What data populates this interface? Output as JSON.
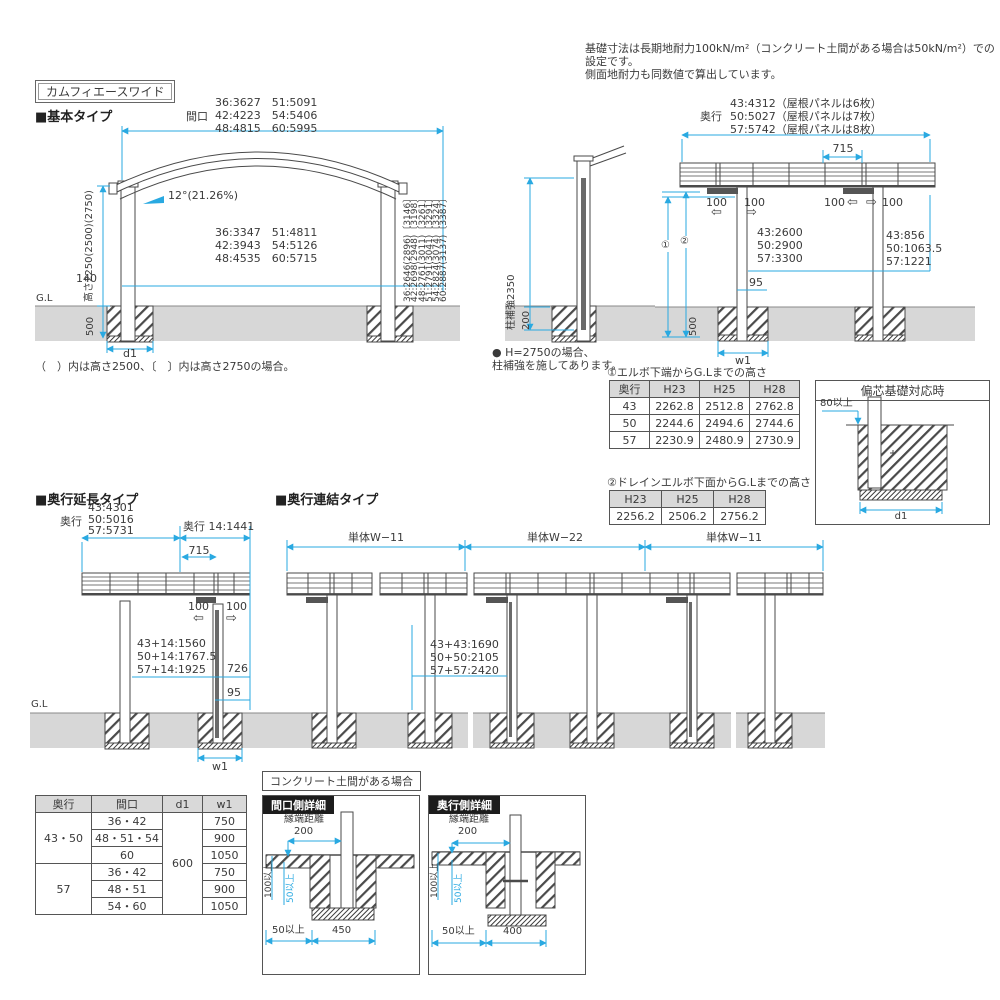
{
  "colors": {
    "dimension": "#29a9e1",
    "ground": "#d7d7d7",
    "table_header": "#d9d9d9",
    "ink": "#3a3a3a"
  },
  "note": {
    "line1": "基礎寸法は長期地耐力100kN/m²（コンクリート土間がある場合は50kN/m²）での設定です。",
    "line2": "側面地耐力も同数値で算出しています。"
  },
  "title": "カムフィエースワイド",
  "basic": {
    "heading": "■基本タイプ",
    "front": {
      "span_label": "間口",
      "span_l1": "36:3627　51:5091",
      "span_l2": "42:4223　54:5406",
      "span_l3": "48:4815　60:5995",
      "slope": "12°(21.26%)",
      "mid_l1": "36:3347　51:4811",
      "mid_l2": "42:3943　54:5126",
      "mid_l3": "48:4535　60:5715",
      "dim_140": "140",
      "height_label": "高さ2250(2500)(2750)",
      "dim_500": "500",
      "gl": "G.L",
      "d1": "d1",
      "right_col": [
        "36:2646(2896)〔3146〕",
        "42:2698(2948)〔3198〕",
        "48:2761(3011)〔3261〕",
        "51:2791(3041)〔3291〕",
        "54:2824(3074)〔3324〕",
        "60:2887(3137)〔3387〕"
      ],
      "footnote": "（　）内は高さ2500、〔　〕内は高さ2750の場合。"
    },
    "pillar": {
      "label": "柱補強2350",
      "dim_200": "200",
      "note_l1": "● H=2750の場合、",
      "note_l2": "柱補強を施してあります。"
    },
    "side": {
      "depth_label": "奥行",
      "depth_l1": "43:4312（屋根パネルは6枚）",
      "depth_l2": "50:5027（屋根パネルは7枚）",
      "depth_l3": "57:5742（屋根パネルは8枚）",
      "dim_715": "715",
      "dim_100": "100",
      "arrow_left": "⇦",
      "arrow_right": "⇨",
      "circle1": "①",
      "circle2": "②",
      "mid_l1": "43:2600",
      "mid_l2": "50:2900",
      "mid_l3": "57:3300",
      "right_l1": "43:856",
      "right_l2": "50:1063.5",
      "right_l3": "57:1221",
      "dim_95": "95",
      "dim_500": "500",
      "w1": "w1"
    }
  },
  "tables": {
    "elbow": {
      "title": "①エルボ下端からG.Lまでの高さ",
      "headers": [
        "奥行",
        "H23",
        "H25",
        "H28"
      ],
      "rows": [
        [
          "43",
          "2262.8",
          "2512.8",
          "2762.8"
        ],
        [
          "50",
          "2244.6",
          "2494.6",
          "2744.6"
        ],
        [
          "57",
          "2230.9",
          "2480.9",
          "2730.9"
        ]
      ]
    },
    "drain": {
      "title": "②ドレインエルボ下面からG.Lまでの高さ",
      "headers": [
        "H23",
        "H25",
        "H28"
      ],
      "rows": [
        [
          "2256.2",
          "2506.2",
          "2756.2"
        ]
      ]
    }
  },
  "eccentric": {
    "title": "偏芯基礎対応時",
    "dim_80": "80以上",
    "d1": "d1"
  },
  "extension": {
    "heading": "■奥行延長タイプ",
    "depth_label": "奥行",
    "main_l1": "43:4301",
    "main_l2": "50:5016",
    "main_l3": "57:5731",
    "ext_label": "奥行 14:1441",
    "dim_715": "715",
    "dim_100": "100",
    "arrow_left": "⇦",
    "arrow_right": "⇨",
    "sum_l1": "43+14:1560",
    "sum_l2": "50+14:1767.5",
    "sum_l3": "57+14:1925",
    "dim_726": "726",
    "dim_95": "95",
    "gl": "G.L",
    "w1": "w1"
  },
  "connection": {
    "heading": "■奥行連結タイプ",
    "span1": "単体W−11",
    "span2": "単体W−22",
    "span3": "単体W−11",
    "sum_l1": "43+43:1690",
    "sum_l2": "50+50:2105",
    "sum_l3": "57+57:2420"
  },
  "spec_table": {
    "headers": [
      "奥行",
      "間口",
      "d1",
      "w1"
    ],
    "depth1": "43・50",
    "depth2": "57",
    "d1": "600",
    "rows": [
      [
        "36・42",
        "750"
      ],
      [
        "48・51・54",
        "900"
      ],
      [
        "60",
        "1050"
      ],
      [
        "36・42",
        "750"
      ],
      [
        "48・51",
        "900"
      ],
      [
        "54・60",
        "1050"
      ]
    ]
  },
  "details": {
    "concrete_note": "コンクリート土間がある場合",
    "maguchi": {
      "title": "間口側詳細",
      "edge_label": "縁端距離",
      "dim_200": "200",
      "dim_100": "100以上",
      "dim_50v": "50以上",
      "dim_50h": "50以上",
      "width": "450"
    },
    "okuyuki": {
      "title": "奥行側詳細",
      "edge_label": "縁端距離",
      "dim_200": "200",
      "dim_100": "100以上",
      "dim_50v": "50以上",
      "dim_50h": "50以上",
      "width": "400"
    }
  }
}
